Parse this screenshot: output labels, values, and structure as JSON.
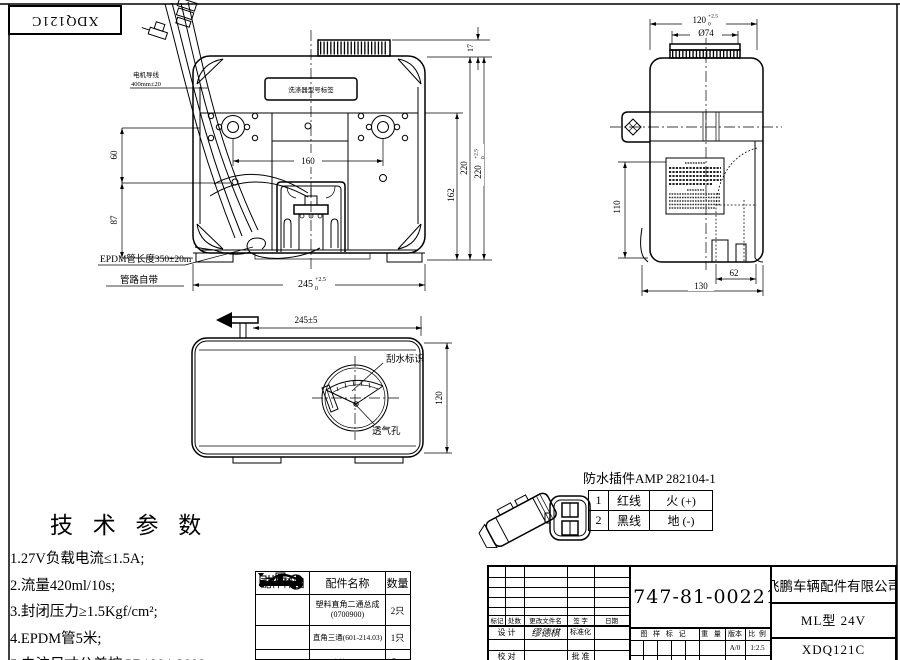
{
  "sheet": {
    "corner_stamp": "XDQ121C",
    "line_color": "#000000",
    "bg_color": "#ffffff"
  },
  "front_view": {
    "label_box": "洗涤器型号标签",
    "callout_motor_wire_1": "电机导线",
    "callout_motor_wire_2": "400mm±20",
    "callout_hose_1": "EPDM管长度350±20m",
    "callout_hose_2": "管路自带",
    "dim_pump_span": "160",
    "dim_left_upper": "60",
    "dim_left_lower": "87",
    "dim_inner_height": "162",
    "dim_body_height": "220",
    "dim_overall_height": "220",
    "dim_overall_tol_up": "+2.5",
    "dim_overall_tol_dn": "0",
    "dim_cap_height": "17",
    "dim_width": "245",
    "dim_width_tol_up": "+2.5",
    "dim_width_tol_dn": "0"
  },
  "side_view": {
    "dim_top_width": "120",
    "dim_top_tol_up": "+2.5",
    "dim_top_tol_dn": "0",
    "dim_cap_dia": "Ø74",
    "dim_pocket_height": "110",
    "dim_pocket_width": "62",
    "dim_depth": "130"
  },
  "top_view": {
    "dim_width": "245±5",
    "dim_height": "120",
    "label_wiper": "刮水标识",
    "label_vent": "透气孔"
  },
  "tech_params": {
    "title": "技 术 参 数",
    "items": [
      "1.27V负载电流≤1.5A;",
      "2.流量420ml/10s;",
      "3.封闭压力≥1.5Kgf/cm²;",
      "4.EPDM管5米;",
      "5.未注尺寸公差按GB1804-2000。"
    ]
  },
  "connector": {
    "title": "防水插件AMP 282104-1",
    "pins": [
      {
        "no": "1",
        "wire": "红线",
        "signal": "火 (+)"
      },
      {
        "no": "2",
        "wire": "黑线",
        "signal": "地 (-)"
      }
    ]
  },
  "parts_table": {
    "headers": [
      "配件样图",
      "配件名称",
      "数量"
    ],
    "rows": [
      {
        "name_1": "塑料直角二通总成",
        "name_2": "(0700900)",
        "qty": "2只"
      },
      {
        "name_1": "直角三通(601-214.03)",
        "name_2": "",
        "qty": "1只"
      },
      {
        "name_1": "EPDM水管(101-04071)",
        "name_2": "",
        "qty": "5m"
      }
    ]
  },
  "title_block": {
    "part_number": "3747-81-00221",
    "company": "飞鹏车辆配件有限公司",
    "model": "ML型 24V",
    "drawing_number": "XDQ121C",
    "rev_cols": [
      "标记",
      "处数",
      "更改文件名",
      "签 字",
      "日期"
    ],
    "design_label": "设 计",
    "designer": "缪德棋",
    "standardization_label": "标准化",
    "check_label": "校 对",
    "approve_label": "批 准",
    "mark_label": "图 样 标 记",
    "weight_label": "重 量",
    "version_label": "版本",
    "scale_label": "比 例",
    "version": "A/0",
    "scale": "1:2.5"
  }
}
